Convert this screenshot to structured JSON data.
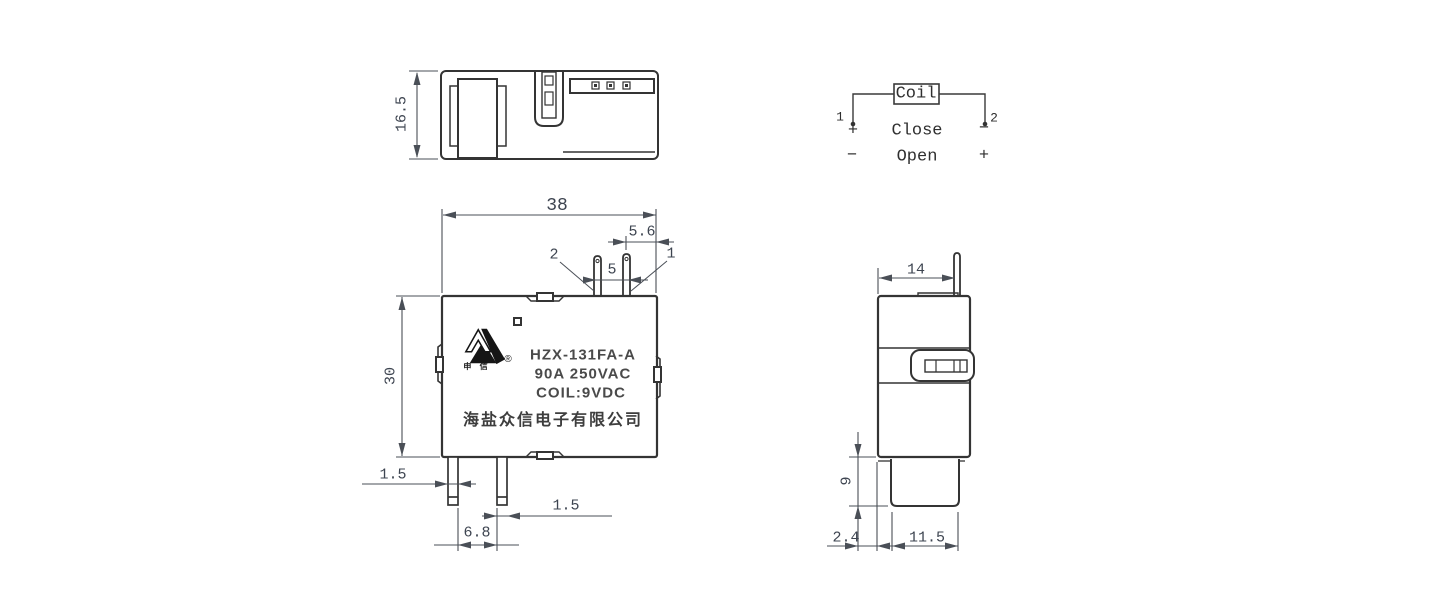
{
  "views": {
    "top_view": {
      "dim_height": "16.5"
    },
    "schematic": {
      "coil_label": "Coil",
      "terminal_1": "1",
      "terminal_2": "2",
      "row_close": {
        "left": "+",
        "label": "Close",
        "right": "−"
      },
      "row_open": {
        "left": "−",
        "label": "Open",
        "right": "+"
      }
    },
    "front_view": {
      "dim_width": "38",
      "dim_pin_to_edge": "5.6",
      "dim_pin_pitch": "5",
      "dim_height": "30",
      "dim_pin_left_w": "1.5",
      "dim_pin_right_w": "1.5",
      "dim_pin_spacing": "6.8",
      "coil_pin_left": "2",
      "coil_pin_right": "1",
      "marking": {
        "logo_caption": "申 信",
        "registered_mark": "®",
        "model": "HZX-131FA-A",
        "rating": "90A 250VAC",
        "coil_spec": "COIL:9VDC",
        "manufacturer": "海盐众信电子有限公司"
      }
    },
    "side_view": {
      "dim_width": "14",
      "dim_base_height": "9",
      "dim_offset": "2.4",
      "dim_base_width": "11.5"
    }
  },
  "colors": {
    "object_line": "#343434",
    "dim_line": "#4a4f57",
    "text": "#3d4450"
  }
}
